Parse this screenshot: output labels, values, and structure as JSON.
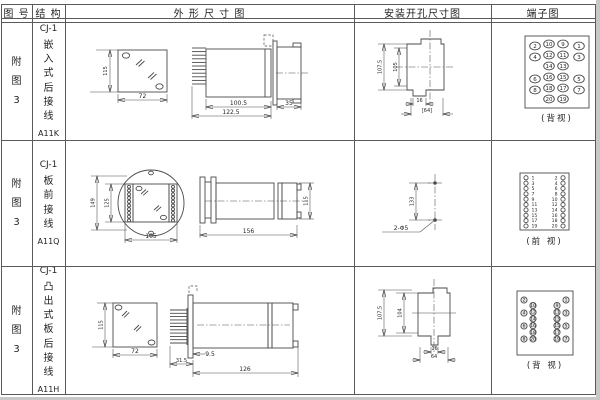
{
  "page": {
    "bg": "#ffffff",
    "line_color": "#4a4a4a",
    "edge_color": "#c8c8c8"
  },
  "headers": {
    "fig_no": "图 号",
    "structure": "结 构",
    "outline": "外 形 尺 寸 图",
    "mounting": "安装开孔尺寸图",
    "terminal": "端子图"
  },
  "rows": [
    {
      "fig_no": "附图3",
      "model": "CJ-1",
      "structure_type": "嵌入式后接线",
      "code": "A11K",
      "outline_dims": {
        "front_h": "115",
        "front_w": "72",
        "body_l": "100.5",
        "total_l": "122.5",
        "rear_l": "35"
      },
      "mounting_dims": {
        "outer_h": "107.5",
        "inner_h": "105",
        "slot_w": "16",
        "panel_w": "[64]"
      },
      "terminal": {
        "view_label": "(背视)",
        "numbers": [
          "2",
          "10",
          "9",
          "1",
          "4",
          "12",
          "11",
          "3",
          "14",
          "13",
          "6",
          "16",
          "15",
          "5",
          "8",
          "18",
          "17",
          "7",
          "20",
          "19"
        ]
      }
    },
    {
      "fig_no": "附图3",
      "model": "CJ-1",
      "structure_type": "板前接线",
      "code": "A11Q",
      "outline_dims": {
        "front_h": "149",
        "inner_h": "125",
        "front_w": "105",
        "side_l": "156",
        "side_h": "115"
      },
      "mounting_dims": {
        "hole_dist": "133",
        "holes": "2-Φ5"
      },
      "terminal": {
        "view_label": "(前 视)",
        "left_numbers": [
          "1",
          "3",
          "5",
          "7",
          "9",
          "11",
          "13",
          "15",
          "17",
          "19"
        ],
        "right_numbers": [
          "2",
          "4",
          "6",
          "8",
          "10",
          "12",
          "14",
          "16",
          "18",
          "20"
        ]
      }
    },
    {
      "fig_no": "附图3",
      "model": "CJ-1",
      "structure_type": "凸出式板后接线",
      "code": "A11H",
      "outline_dims": {
        "front_h": "115",
        "front_w": "72",
        "pin_l": "31.5",
        "panel_off": "9.5",
        "body_l": "126"
      },
      "mounting_dims": {
        "outer_h": "107.5",
        "inner_h": "104",
        "slot_w": "16",
        "panel_w": "64"
      },
      "terminal": {
        "view_label": "(背 视)",
        "left_outer": [
          "2",
          "4",
          "6",
          "8"
        ],
        "left_inner": [
          "10",
          "12",
          "14",
          "16",
          "18",
          "20"
        ],
        "right_inner": [
          "9",
          "11",
          "13",
          "15",
          "17",
          "19"
        ],
        "right_outer": [
          "1",
          "3",
          "5",
          "7"
        ]
      }
    }
  ]
}
